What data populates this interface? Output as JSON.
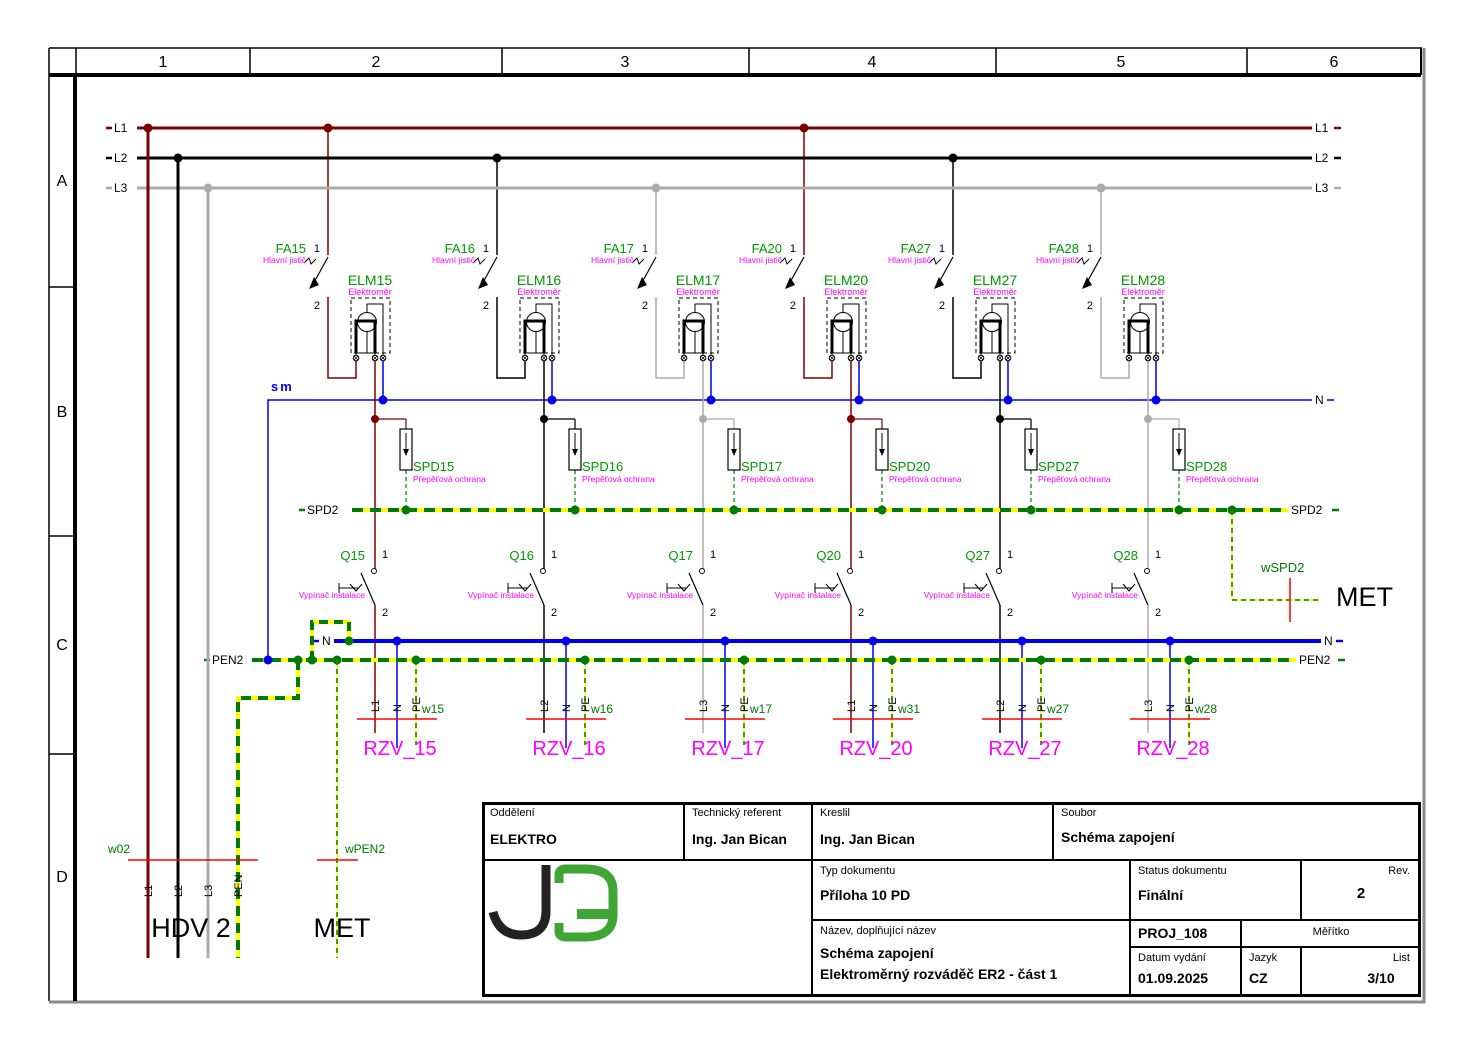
{
  "grid": {
    "columns": [
      "1",
      "2",
      "3",
      "4",
      "5",
      "6"
    ],
    "rows": [
      "A",
      "B",
      "C",
      "D"
    ]
  },
  "colors": {
    "phase_L1": "#7B0000",
    "phase_L2": "#000000",
    "phase_L3": "#ABABAB",
    "neutral_blue": "#0000EE",
    "pe_green": "#007A00",
    "pe_yellow": "#FFFF00",
    "device_label_green": "#009900",
    "wire_label_green": "#007700",
    "description_magenta": "#FF00FF",
    "outlet_magenta": "#FF00FF",
    "cable_marker_red": "#FF0000"
  },
  "buses": {
    "l1": {
      "name": "L1"
    },
    "l2": {
      "name": "L2"
    },
    "l3": {
      "name": "L3"
    },
    "sm": {
      "name": "sm",
      "right_label": "N"
    },
    "spd2": {
      "name": "SPD2"
    },
    "n": {
      "name": "N"
    },
    "pen2": {
      "name": "PEN2"
    }
  },
  "branches": [
    {
      "breaker": "FA15",
      "breaker_desc": "Hlavní jistič",
      "terminal_top": "1",
      "terminal_bottom": "2",
      "meter": "ELM15",
      "meter_desc": "Elektroměr",
      "spd": "SPD15",
      "spd_desc": "Přepěťová ochrana",
      "switch": "Q15",
      "switch_desc": "Vypínač instalace",
      "switch_top": "1",
      "switch_bottom": "2",
      "phase": "L1",
      "cores": [
        "L1",
        "N",
        "PE"
      ],
      "cable": "w15",
      "outlet": "RZV_15"
    },
    {
      "breaker": "FA16",
      "breaker_desc": "Hlavní jistič",
      "terminal_top": "1",
      "terminal_bottom": "2",
      "meter": "ELM16",
      "meter_desc": "Elektroměr",
      "spd": "SPD16",
      "spd_desc": "Přepěťová ochrana",
      "switch": "Q16",
      "switch_desc": "Vypínač instalace",
      "switch_top": "1",
      "switch_bottom": "2",
      "phase": "L2",
      "cores": [
        "L2",
        "N",
        "PE"
      ],
      "cable": "w16",
      "outlet": "RZV_16"
    },
    {
      "breaker": "FA17",
      "breaker_desc": "Hlavní jistič",
      "terminal_top": "1",
      "terminal_bottom": "2",
      "meter": "ELM17",
      "meter_desc": "Elektroměr",
      "spd": "SPD17",
      "spd_desc": "Přepěťová ochrana",
      "switch": "Q17",
      "switch_desc": "Vypínač instalace",
      "switch_top": "1",
      "switch_bottom": "2",
      "phase": "L3",
      "cores": [
        "L3",
        "N",
        "PE"
      ],
      "cable": "w17",
      "outlet": "RZV_17"
    },
    {
      "breaker": "FA20",
      "breaker_desc": "Hlavní jistič",
      "terminal_top": "1",
      "terminal_bottom": "2",
      "meter": "ELM20",
      "meter_desc": "Elektroměr",
      "spd": "SPD20",
      "spd_desc": "Přepěťová ochrana",
      "switch": "Q20",
      "switch_desc": "Vypínač instalace",
      "switch_top": "1",
      "switch_bottom": "2",
      "phase": "L1",
      "cores": [
        "L1",
        "N",
        "PE"
      ],
      "cable": "w31",
      "outlet": "RZV_20"
    },
    {
      "breaker": "FA27",
      "breaker_desc": "Hlavní jistič",
      "terminal_top": "1",
      "terminal_bottom": "2",
      "meter": "ELM27",
      "meter_desc": "Elektroměr",
      "spd": "SPD27",
      "spd_desc": "Přepěťová ochrana",
      "switch": "Q27",
      "switch_desc": "Vypínač instalace",
      "switch_top": "1",
      "switch_bottom": "2",
      "phase": "L2",
      "cores": [
        "L2",
        "N",
        "PE"
      ],
      "cable": "w27",
      "outlet": "RZV_27"
    },
    {
      "breaker": "FA28",
      "breaker_desc": "Hlavní jistič",
      "terminal_top": "1",
      "terminal_bottom": "2",
      "meter": "ELM28",
      "meter_desc": "Elektroměr",
      "spd": "SPD28",
      "spd_desc": "Přepěťová ochrana",
      "switch": "Q28",
      "switch_desc": "Vypínač instalace",
      "switch_top": "1",
      "switch_bottom": "2",
      "phase": "L3",
      "cores": [
        "L3",
        "N",
        "PE"
      ],
      "cable": "w28",
      "outlet": "RZV_28"
    }
  ],
  "incoming_feeder": {
    "label": "HDV 2",
    "cable": "w02",
    "cores": [
      "L1",
      "L2",
      "L3",
      "PEN"
    ]
  },
  "met_feeder": {
    "label": "MET",
    "cable": "wPEN2"
  },
  "met_spd_feeder": {
    "label": "MET",
    "cable": "wSPD2"
  },
  "title_block": {
    "department_label": "Oddělení",
    "department": "ELEKTRO",
    "technical_referent_label": "Technický referent",
    "technical_referent": "Ing. Jan Bican",
    "drawn_by_label": "Kreslil",
    "drawn_by": "Ing. Jan Bican",
    "file_label": "Soubor",
    "file": "Schéma zapojení",
    "document_type_label": "Typ dokumentu",
    "document_type": "Příloha 10 PD",
    "status_label": "Status dokumentu",
    "status": "Finální",
    "revision_label": "Rev.",
    "revision": "2",
    "name_label": "Název, doplňující název",
    "name_line1": "Schéma zapojení",
    "name_line2": "Elektroměrný rozváděč ER2 - část 1",
    "project": "PROJ_108",
    "scale_label": "Měřítko",
    "scale": "",
    "issue_date_label": "Datum vydání",
    "issue_date": "01.09.2025",
    "language_label": "Jazyk",
    "language": "CZ",
    "sheet_label": "List",
    "sheet": "3/10",
    "logo": "JB"
  }
}
